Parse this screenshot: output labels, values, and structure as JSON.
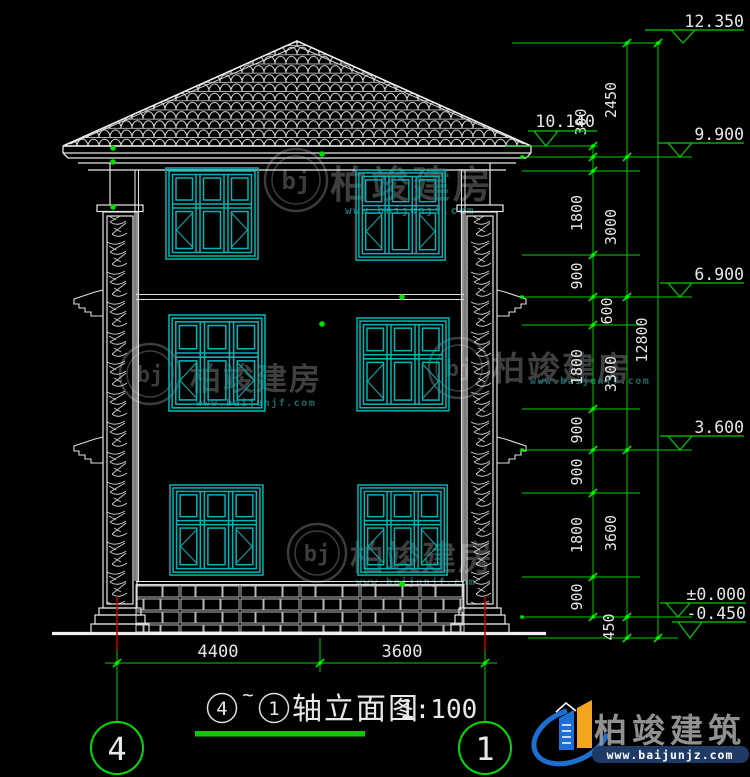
{
  "colors": {
    "background": "#000000",
    "line_white": "#e8e8e8",
    "dimension_green": "#00dd00",
    "grip_green": "#00ff00",
    "window_cyan": "#00b4b4",
    "axis_red": "#c40000",
    "watermark_gray": "#3f3f3f",
    "watermark_teal": "#1e6a6a",
    "brand_blue": "#1d6fd1",
    "brand_orange": "#f5a51d",
    "brand_navy": "#203a66"
  },
  "levels": {
    "ridge": "12.350",
    "eave_upper": "10.140",
    "eave": "9.900",
    "floor3": "6.900",
    "floor2": "3.600",
    "zero": "±0.000",
    "ground": "-0.450"
  },
  "dims": {
    "chain_a": [
      "300",
      "1800",
      "900",
      "600",
      "1800",
      "900",
      "900",
      "1800",
      "900"
    ],
    "chain_b": [
      "2450",
      "3000",
      "3300",
      "3600",
      "450"
    ],
    "overall": "12800",
    "bottom": [
      "4400",
      "3600"
    ]
  },
  "axes": {
    "left": "4",
    "right": "1"
  },
  "title": {
    "axis_a": "4",
    "tilde": "~",
    "axis_b": "1",
    "text": "轴立面图",
    "scale": "1:100"
  },
  "watermark": {
    "monogram": "bj",
    "name": "柏竣建房",
    "url": "www.baijunjf.com"
  },
  "brand": {
    "name": "柏竣建筑",
    "url": "www.baijunjz.com"
  }
}
